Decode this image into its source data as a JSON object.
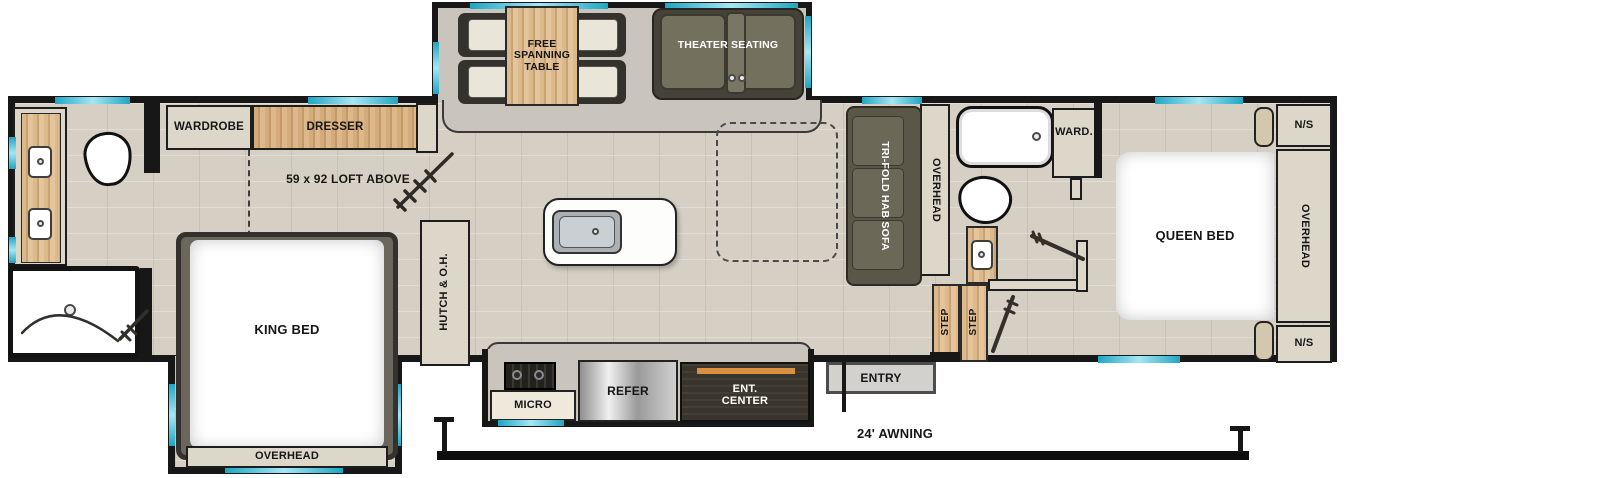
{
  "figure": "fifth-wheel RV floorplan, top view",
  "colors": {
    "wall": "#171717",
    "floor": "#d6d0c4",
    "slide_floor": "#c9c5bd",
    "wood": "#cfa878",
    "cabinet": "#dcd7c9",
    "dark_upholstery": "#5a5748",
    "window_glass": "#35b9d6",
    "accent_orange": "#d9913f"
  },
  "rooms": {
    "dining_slide": {
      "table": "FREE SPANNING TABLE",
      "theater": "THEATER SEATING"
    },
    "front_suite": {
      "wardrobe": "WARDROBE",
      "dresser": "DRESSER",
      "loft_note": "59 x 92 LOFT ABOVE",
      "bed": "KING BED",
      "overhead": "OVERHEAD"
    },
    "kitchen": {
      "hutch": "HUTCH & O.H.",
      "micro": "MICRO",
      "refer": "REFER",
      "ent_center": "ENT. CENTER"
    },
    "living": {
      "sofa": "TRI-FOLD HAB SOFA",
      "overhead": "OVERHEAD"
    },
    "mid_bath": {
      "step_upper": "STEP",
      "step_lower": "STEP"
    },
    "rear_suite": {
      "wardrobe": "WARD.",
      "bed": "QUEEN BED",
      "overhead": "OVERHEAD",
      "nightstand_top": "N/S",
      "nightstand_bottom": "N/S"
    },
    "exterior": {
      "entry": "ENTRY",
      "awning": "24' AWNING"
    }
  }
}
